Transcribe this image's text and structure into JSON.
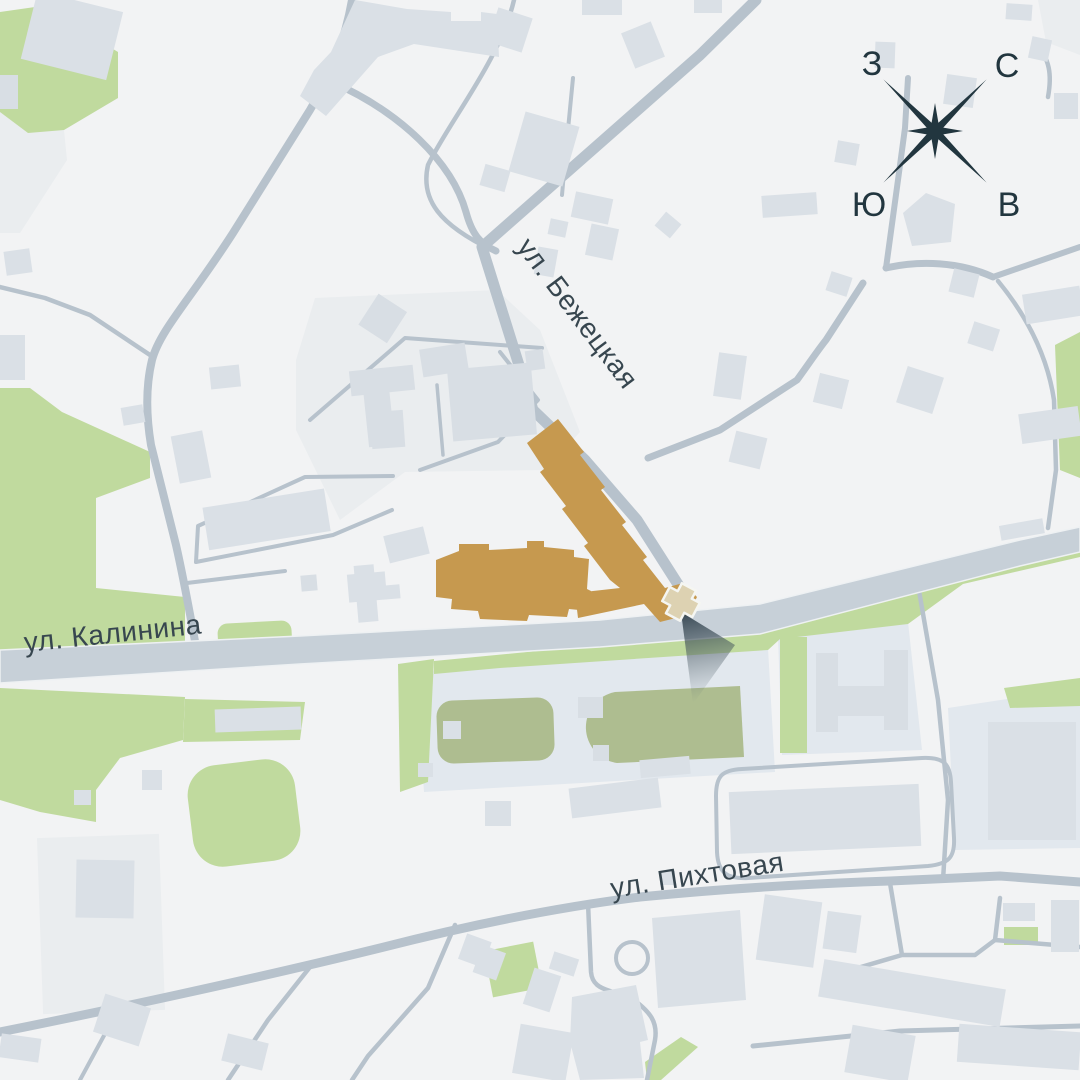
{
  "colors": {
    "bg": "#f2f3f4",
    "parcel": "#eaedef",
    "parcel-blue": "#e2e8ee",
    "building": "#dae0e6",
    "building-dark": "#d8dee4",
    "green": "#c0da9e",
    "green-olive": "#aebd90",
    "road": "#b7c2cc",
    "road-main": "#c7d0d8",
    "road-casing": "#eef1f3",
    "highlight": "#c6994f",
    "marker": "#ddd2b2",
    "navy": "#22363f",
    "label": "#37464f"
  },
  "labels": {
    "street_kalinina": "ул. Калинина",
    "street_bezhetskaya": "ул. Бежецкая",
    "street_pikhtovaya": "ул. Пихтовая"
  },
  "compass": {
    "west": "З",
    "north": "С",
    "south": "Ю",
    "east": "В"
  }
}
